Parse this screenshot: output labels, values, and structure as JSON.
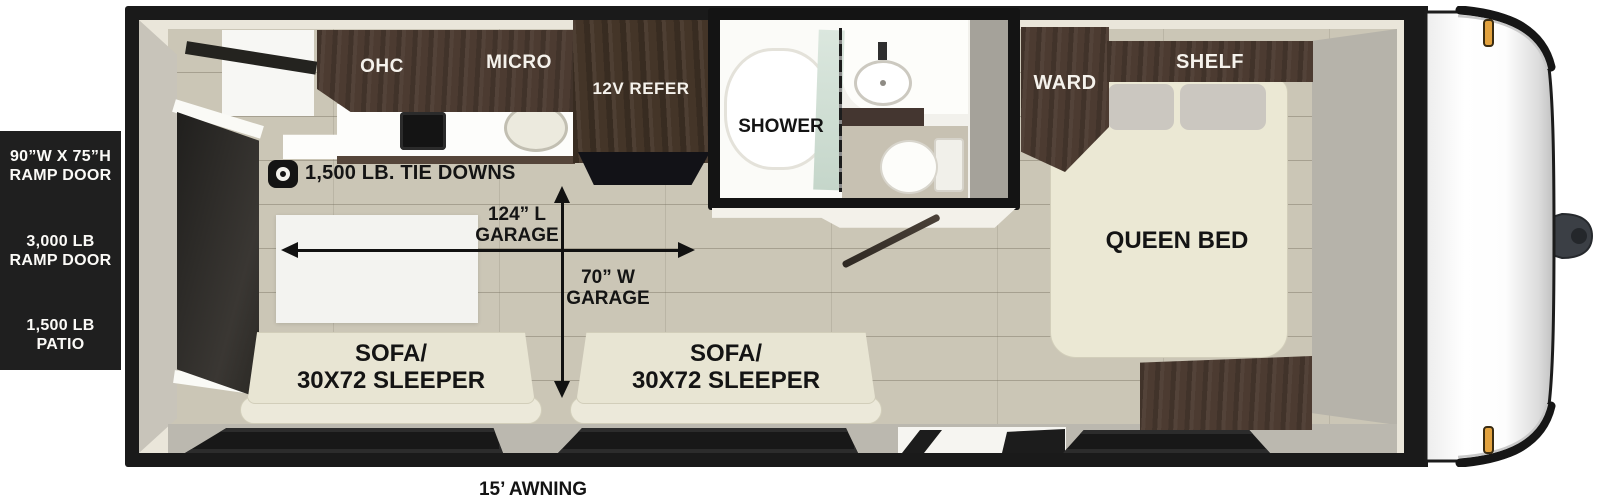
{
  "specs_panel": {
    "groups": [
      {
        "line1": "90”W X 75”H",
        "line2": "RAMP DOOR"
      },
      {
        "line1": "3,000 LB",
        "line2": "RAMP DOOR"
      },
      {
        "line1": "1,500 LB",
        "line2": "PATIO"
      }
    ]
  },
  "kitchen": {
    "ohc_label": "OHC",
    "micro_label": "MICRO",
    "refer_label": "12V REFER"
  },
  "cargo": {
    "tie_downs_label": "1,500 LB. TIE DOWNS",
    "garage_length_line1": "124” L",
    "garage_length_line2": "GARAGE",
    "garage_width_line1": "70” W",
    "garage_width_line2": "GARAGE"
  },
  "bathroom": {
    "shower_label": "SHOWER"
  },
  "bedroom": {
    "ward_label": "WARD",
    "shelf_label": "SHELF",
    "bed_label": "QUEEN BED"
  },
  "sofas": [
    {
      "line1": "SOFA/",
      "line2": "30X72 SLEEPER"
    },
    {
      "line1": "SOFA/",
      "line2": "30X72 SLEEPER"
    }
  ],
  "exterior": {
    "awning_label": "15’ AWNING"
  },
  "colors": {
    "outline_black": "#1a1a1a",
    "cabinet_brown": "#4c3b31",
    "floor_tan": "#cbc6b6",
    "sofa_cream": "#e8e5d3",
    "wall_cream": "#eae6da",
    "marker_amber": "#e2a23f"
  }
}
